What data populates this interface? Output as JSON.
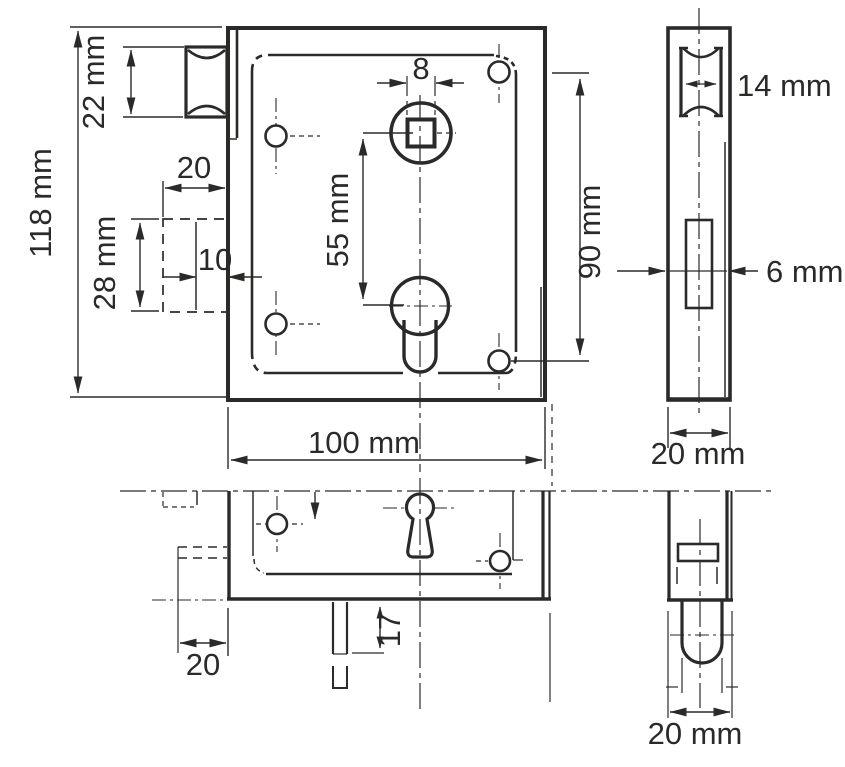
{
  "drawing": {
    "title": "Rim lock technical drawing",
    "line_color": "#2b2a29",
    "views": {
      "front": "front view",
      "side": "side view",
      "bottom": "bottom view",
      "cylinder_side": "cylinder side view"
    },
    "labels": {
      "case_height": "118 mm",
      "roller_height": "22 mm",
      "recess_depth": "20",
      "recess_offset": "10",
      "recess_height": "28 mm",
      "follower_square_width": "8",
      "follower_to_cylinder": "55 mm",
      "screw_hole_spacing": "90 mm",
      "case_width": "100 mm",
      "roller_width": "14 mm",
      "slot_width": "6 mm",
      "side_case_depth": "20 mm",
      "escutcheon_offset": "20",
      "spindle_protrusion": "17",
      "cylinder_case_depth": "20 mm"
    }
  }
}
